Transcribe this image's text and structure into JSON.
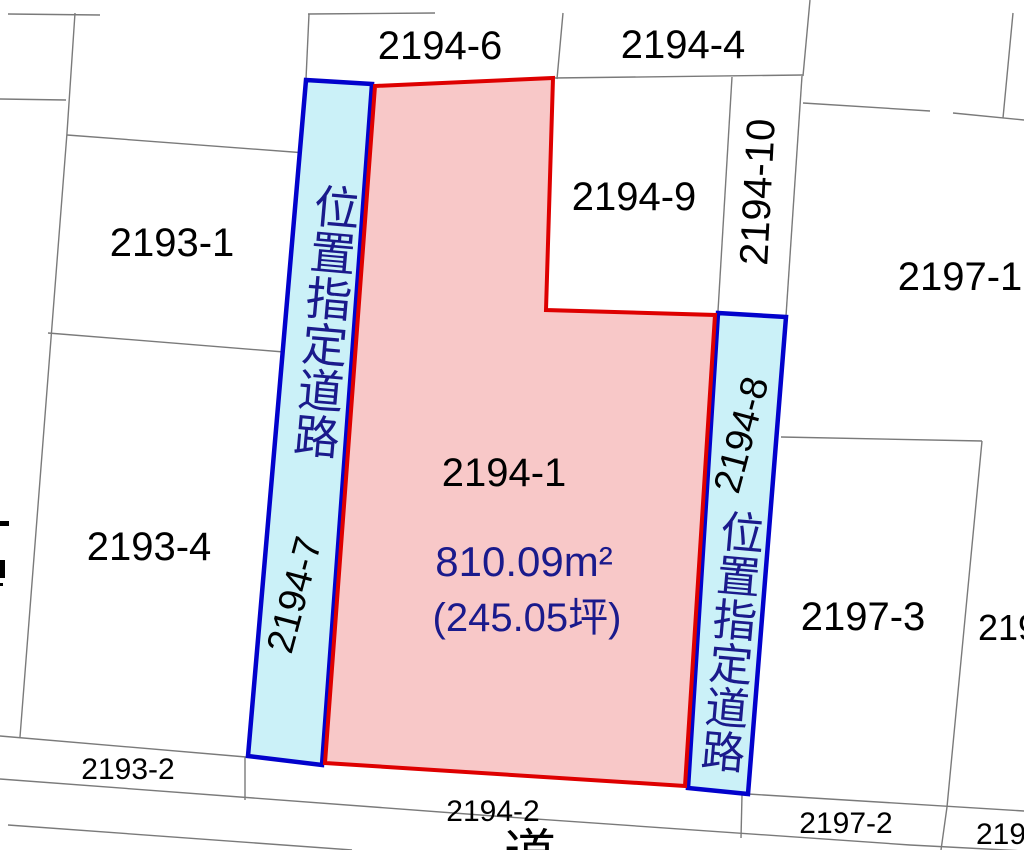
{
  "map": {
    "main_parcel": {
      "number": "2194-1",
      "area_m2": "810.09m²",
      "area_tsubo": "(245.05坪)"
    },
    "roads": {
      "left": {
        "number": "2194-7",
        "label": "位置指定道路"
      },
      "right": {
        "number": "2194-8",
        "label": "位置指定道路"
      },
      "bottom": {
        "number": "2194-2",
        "label": "道"
      }
    },
    "parcels": {
      "p2194_6": "2194-6",
      "p2194_4": "2194-4",
      "p2194_9": "2194-9",
      "p2194_10": "2194-10",
      "p2197_1": "2197-1",
      "p2193_1": "2193-1",
      "p2193_4": "2193-4",
      "p2193_2": "2193-2",
      "p2197_2": "2197-2",
      "p2197_3": "2197-3",
      "p2199_partial": "2199",
      "p219_partial": "219"
    },
    "colors": {
      "highlight_fill": "#F8C8C8",
      "highlight_border": "#DE0000",
      "road_fill": "#CBF1F8",
      "road_border": "#0202CC",
      "boundary_line": "#7A7A7A",
      "label_text": "#000000",
      "area_text": "#1A1A8C"
    }
  }
}
